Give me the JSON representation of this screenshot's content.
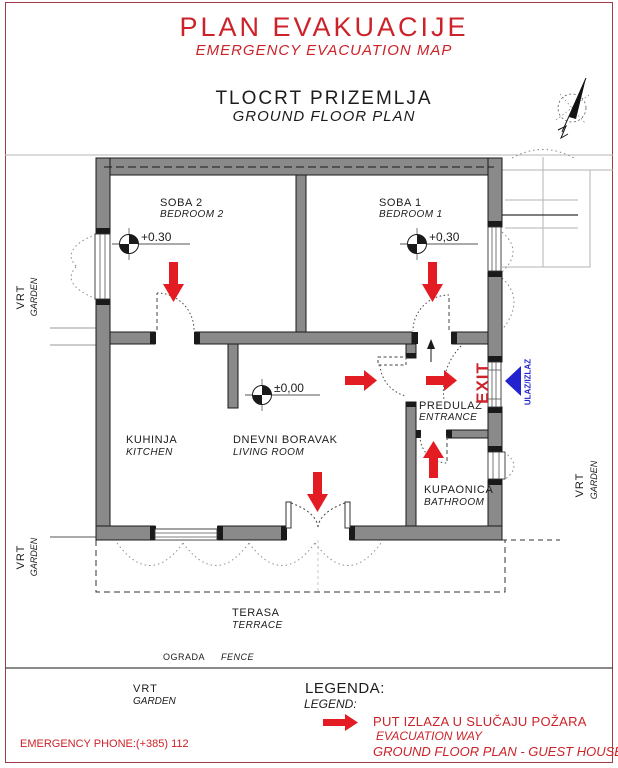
{
  "header": {
    "title": "PLAN EVAKUACIJE",
    "subtitle": "EMERGENCY  EVACUATION  MAP",
    "plan_title": "TLOCRT  PRIZEMLJA",
    "plan_subtitle": "GROUND FLOOR PLAN"
  },
  "rooms": {
    "bedroom2": {
      "hr": "SOBA 2",
      "en": "BEDROOM 2",
      "level": "+0.30"
    },
    "bedroom1": {
      "hr": "SOBA 1",
      "en": "BEDROOM 1",
      "level": "+0,30"
    },
    "kitchen": {
      "hr": "KUHINJA",
      "en": "KITCHEN"
    },
    "living": {
      "hr": "DNEVNI BORAVAK",
      "en": "LIVING ROOM",
      "level": "±0,00"
    },
    "entrance": {
      "hr": "PREDULAZ",
      "en": "ENTRANCE"
    },
    "bathroom": {
      "hr": "KUPAONICA",
      "en": "BATHROOM"
    },
    "terrace": {
      "hr": "TERASA",
      "en": "TERRACE"
    }
  },
  "outdoor": {
    "garden_hr": "VRT",
    "garden_en": "GARDEN",
    "fence_hr": "OGRADA",
    "fence_en": "FENCE"
  },
  "signs": {
    "exit": "EXIT",
    "entry_exit": "ULAZ/IZLAZ"
  },
  "legend": {
    "title_hr": "LEGENDA:",
    "title_en": "LEGEND:",
    "item_hr": "PUT  IZLAZA U SLUČAJU POŽARA",
    "item_en": "EVACUATION  WAY",
    "footer": "GROUND FLOOR PLAN - GUEST HOUSE"
  },
  "footer": {
    "emergency_phone": "EMERGENCY PHONE:(+385) 112"
  },
  "icons": {
    "compass": "north-arrow",
    "evacuation_arrow": "red-evacuation-arrow",
    "entry_arrow": "blue-entry-exit-arrow",
    "level_marker": "elevation-level-marker"
  },
  "colors": {
    "red": "#cc2229",
    "arrow_red": "#e31c23",
    "blue": "#2222cf",
    "wall": "#8a8a8a",
    "border": "#a23b47"
  }
}
